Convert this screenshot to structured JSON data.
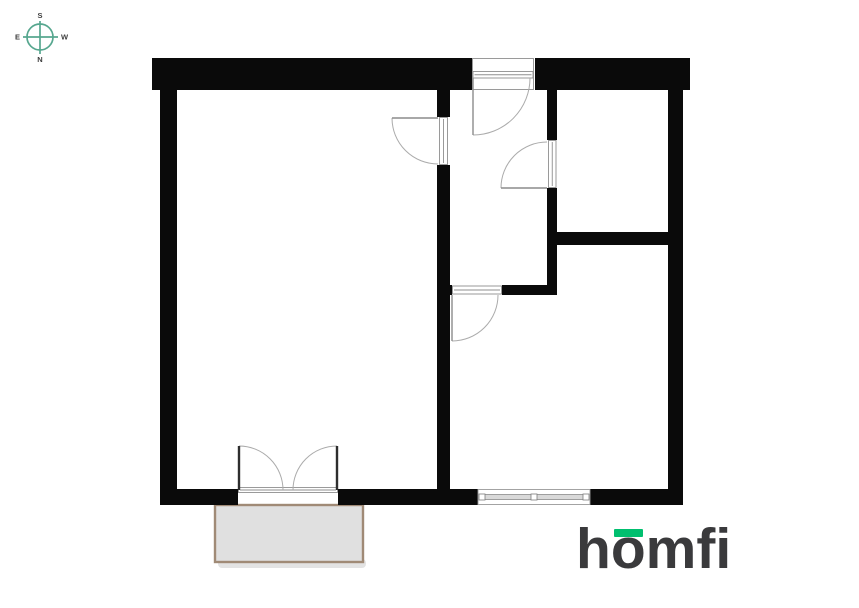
{
  "compass": {
    "labels": {
      "top": "S",
      "bottom": "N",
      "left": "E",
      "right": "W"
    },
    "ring_color": "#57a78f",
    "label_color": "#3d3d3d"
  },
  "logo": {
    "part_h": "h",
    "part_o": "o",
    "part_rest": "mfi",
    "text_color": "#3a3a3c",
    "accent_color": "#00bf6f"
  },
  "floorplan": {
    "bg_color": "#ffffff",
    "wall_color": "#0a0a0a",
    "frame_color": "#8f8f8f",
    "leaf_color": "#8c8c8c",
    "arc_color": "#ababab",
    "window_band_fill": "#d9d9d9",
    "balcony": {
      "x": 215,
      "y": 505,
      "w": 148,
      "h": 57,
      "fill": "#e0e0e0",
      "border": "#a08a76"
    },
    "walls": [
      [
        152,
        58,
        320,
        32
      ],
      [
        535,
        58,
        155,
        32
      ],
      [
        160,
        90,
        17,
        415
      ],
      [
        668,
        90,
        15,
        415
      ],
      [
        160,
        489,
        78,
        16
      ],
      [
        338,
        489,
        140,
        16
      ],
      [
        590,
        489,
        93,
        16
      ],
      [
        437,
        90,
        13,
        27
      ],
      [
        437,
        165,
        13,
        324
      ],
      [
        547,
        90,
        10,
        50
      ],
      [
        547,
        188,
        10,
        107
      ],
      [
        437,
        285,
        15,
        10
      ],
      [
        502,
        285,
        55,
        10
      ],
      [
        557,
        232,
        111,
        13
      ]
    ],
    "door_frames": [
      {
        "x": 472.5,
        "y": 58.5,
        "w": 61,
        "h": 31,
        "strip": false
      },
      {
        "x": 473,
        "y": 71.5,
        "w": 60,
        "h": 6.5,
        "strip": true
      },
      {
        "x": 439.5,
        "y": 117.5,
        "w": 8,
        "h": 47,
        "strip": true
      },
      {
        "x": 548.5,
        "y": 140.5,
        "w": 7.5,
        "h": 47,
        "strip": true
      },
      {
        "x": 452.5,
        "y": 286,
        "w": 49,
        "h": 8,
        "strip": true
      },
      {
        "x": 238.5,
        "y": 487.5,
        "w": 99,
        "h": 5,
        "strip": true
      }
    ],
    "doors": [
      {
        "hinge": [
          473,
          78
        ],
        "r": 57,
        "leaf": 90,
        "closed": 0,
        "sweep": 0,
        "lw": 1.4
      },
      {
        "hinge": [
          438,
          118
        ],
        "r": 46,
        "leaf": 180,
        "closed": 90,
        "sweep": 0,
        "lw": 1.4
      },
      {
        "hinge": [
          547,
          188
        ],
        "r": 46,
        "leaf": 180,
        "closed": 270,
        "sweep": 1,
        "lw": 1.4
      },
      {
        "hinge": [
          452,
          295
        ],
        "r": 46,
        "leaf": 90,
        "closed": 0,
        "sweep": 0,
        "lw": 1.4
      },
      {
        "hinge": [
          239,
          490
        ],
        "r": 44,
        "leaf": 270,
        "closed": 0,
        "sweep": 1,
        "lw": 2.4,
        "lc": "#2e2e2e"
      },
      {
        "hinge": [
          337,
          490
        ],
        "r": 44,
        "leaf": 270,
        "closed": 180,
        "sweep": 0,
        "lw": 2.4,
        "lc": "#2e2e2e"
      }
    ],
    "windows": [
      {
        "x": 478,
        "y": 489.5,
        "w": 112,
        "h": 15
      }
    ]
  }
}
